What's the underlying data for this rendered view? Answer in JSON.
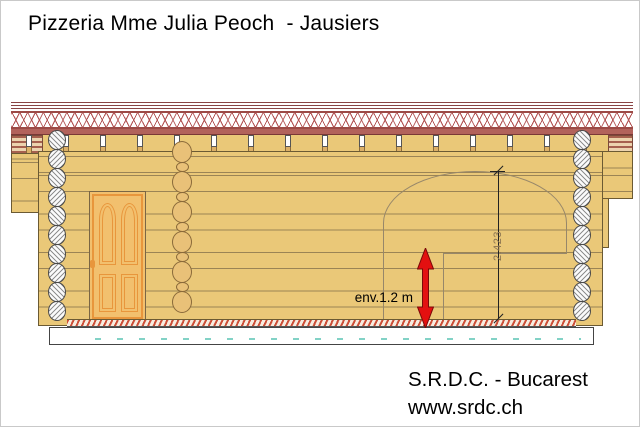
{
  "title": "Pizzeria Mme Julia Peoch  - Jausiers",
  "annotations": {
    "height_dimension": "2.423",
    "approx_height": "env.1.2 m"
  },
  "footer": {
    "company": "S.R.D.C. - Bucarest",
    "website": "www.srdc.ch"
  },
  "colors": {
    "wall_wood": "#eac878",
    "roof_fascia": "#b2625b",
    "lattice_red": "#b35454",
    "door_orange": "#e8963c",
    "arrow_red": "#e31010",
    "foundation_dash_teal": "#82d2c6",
    "outline_brown": "#6b5a33"
  }
}
